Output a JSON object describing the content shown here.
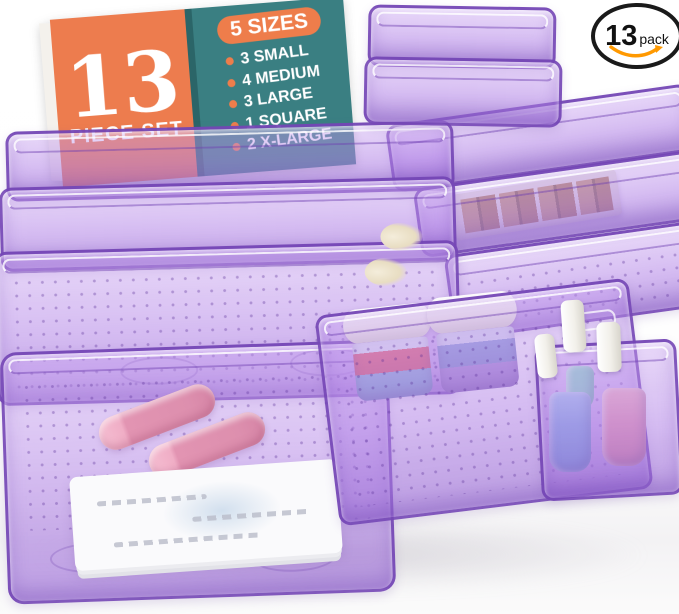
{
  "product_badge": {
    "count": "13",
    "unit": "pack"
  },
  "info_card": {
    "count": "13",
    "set_label": "PIECE SET",
    "sizes_title": "5 SIZES",
    "sizes": [
      "3 SMALL",
      "4 MEDIUM",
      "3 LARGE",
      "1 SQUARE",
      "2 X-LARGE"
    ]
  },
  "scene_items": {
    "bins_material": "transparent purple plastic drawer organizers",
    "contents": [
      "makeup brushes",
      "lipsticks",
      "cream jars",
      "nail polish bottles",
      "eyeshadow palette",
      "paper pad"
    ]
  },
  "colors": {
    "card_orange": "#ED7C4E",
    "card_teal": "#3A7F82",
    "pill_orange": "#EE7D4B",
    "bin_purple": "#A97FD6",
    "bin_rim": "#7042B2",
    "brush_coral": "#EF8465",
    "lipstick_pink": "#E294B2",
    "polish_blue": "#85B4E4",
    "polish_pink": "#F09FAE",
    "polish_teal": "#8FD9C9",
    "swoosh_orange": "#FF9900",
    "badge_ring": "#1A1A1A"
  }
}
